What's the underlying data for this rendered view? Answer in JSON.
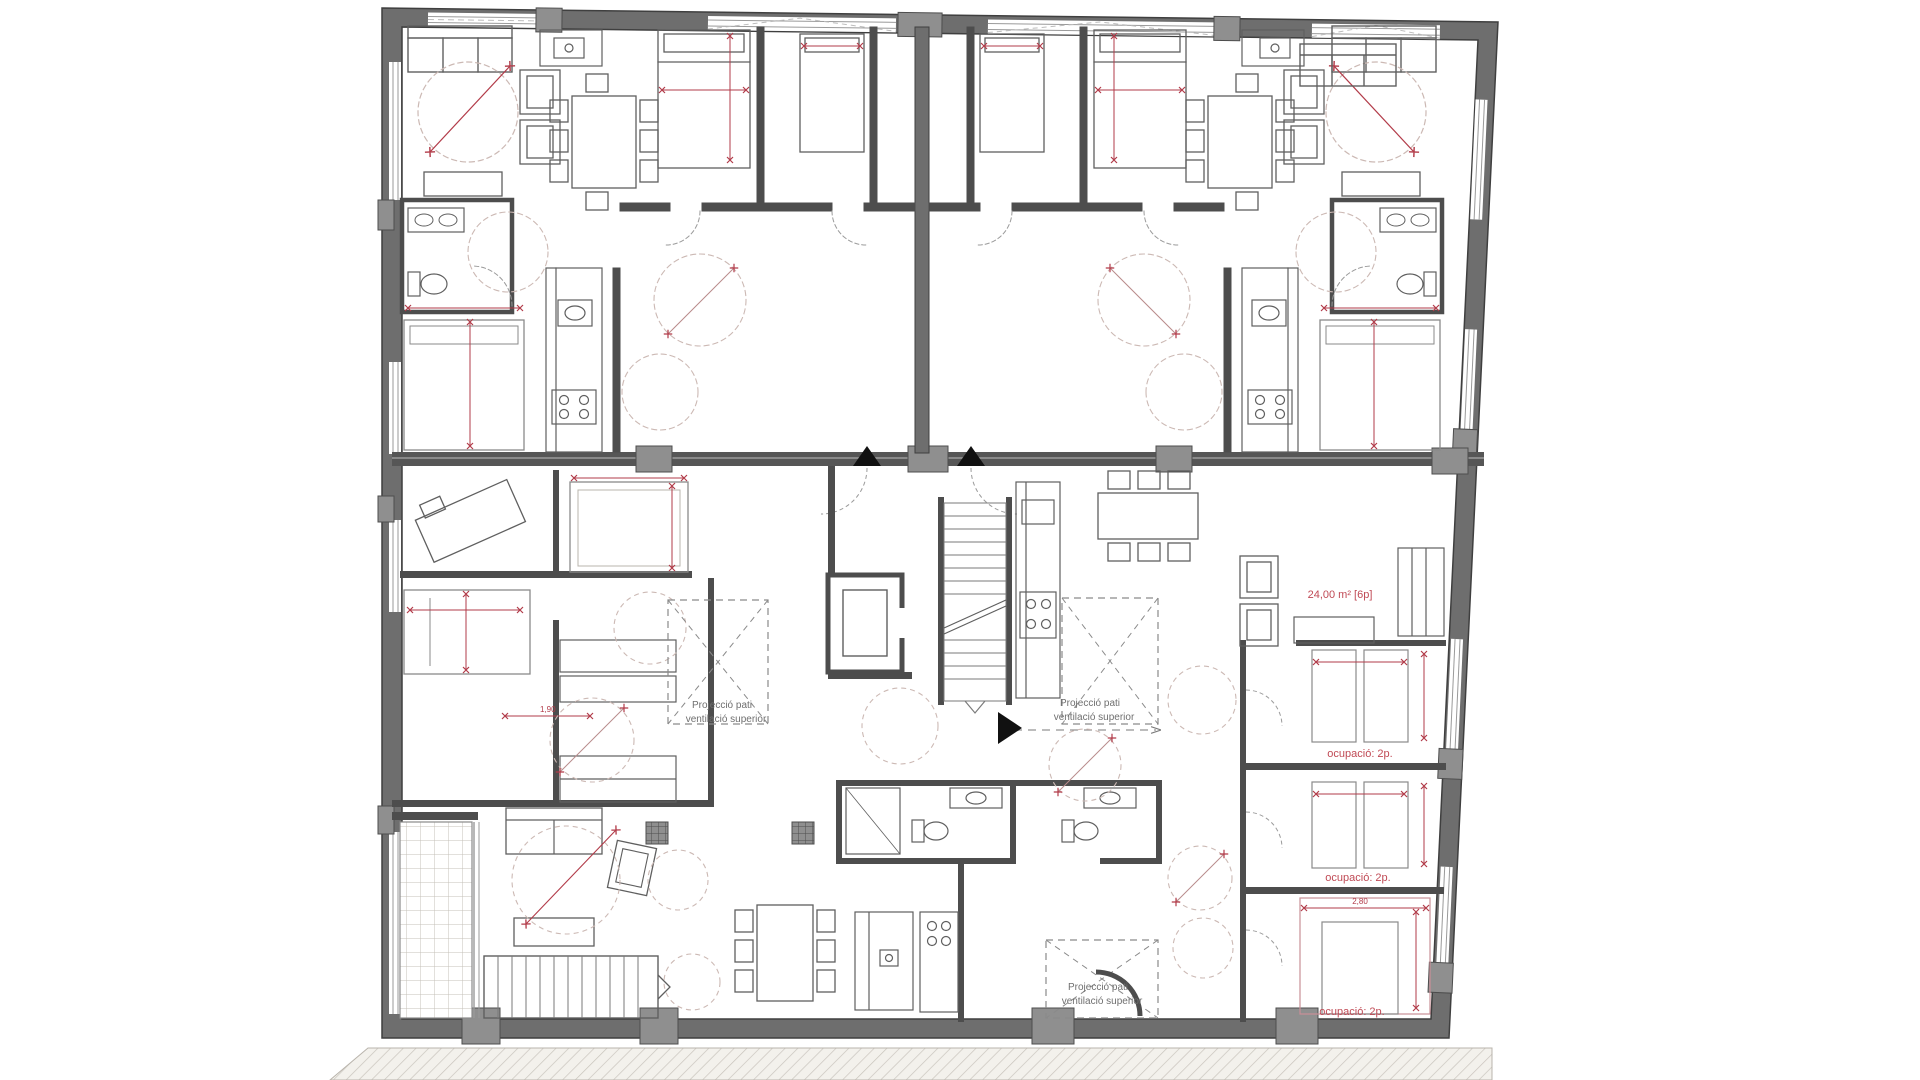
{
  "document": {
    "kind": "architectural floor plan",
    "language": "Catalan",
    "view": "apartment building storey plan with furniture, dimension lines and annotations"
  },
  "colors": {
    "paper": "#ffffff",
    "wall_dark": "#4d4d4d",
    "wall_mid": "#8f8f8f",
    "furniture": "#5f5f5f",
    "furniture_light": "#999999",
    "dimension_red": "#b23b49",
    "label_red": "#c04a55",
    "label_gray": "#6f6f6f",
    "turning_circle": "#ccb9b4",
    "hatch_line": "#c9c4bd",
    "hatch_bg": "#f3f1ec"
  },
  "annotations": {
    "area_label": "24,00 m² [6p]",
    "occupancy_labels": [
      "ocupació: 2p.",
      "ocupació: 2p.",
      "ocupació: 2p."
    ],
    "patio_label": {
      "line1": "Projecció pati",
      "line2": "ventilació superior"
    },
    "dimensions": [
      "2,80",
      "1,90"
    ]
  }
}
